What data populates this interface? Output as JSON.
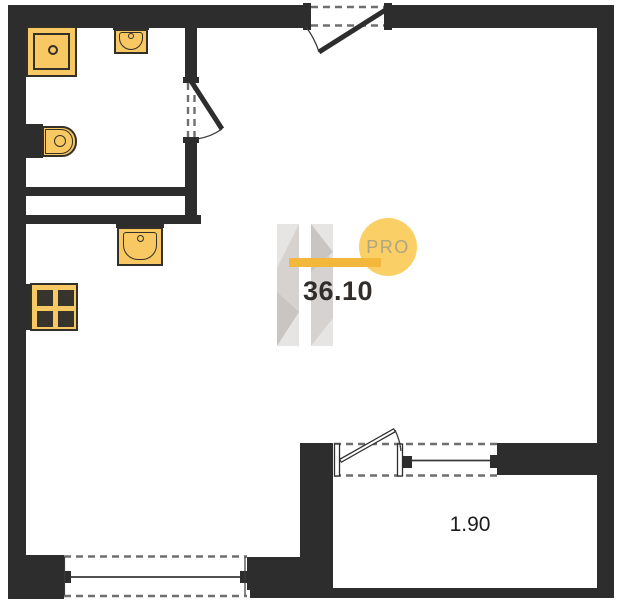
{
  "labels": {
    "area": "36.10",
    "balcony_area": "1.90",
    "logo": "PRO"
  },
  "colors": {
    "wall": "#2d2d2d",
    "line": "#2d2d2d",
    "dash": "#6f6f6f",
    "fixture-fill": "#f8c862",
    "fixture-border": "#33302a",
    "burner": "#37332d",
    "accent": "#f3b73c",
    "logo-circle": "#f9cf66",
    "logo-text": "#b0a482",
    "wm-bar": "#d5d2cf",
    "wm-light": "#e7e5e3",
    "wm-dark": "#c8c5c2",
    "area-text": "#302d2b",
    "balcony-text": "#1d1d1d"
  },
  "fixtures": [
    {
      "name": "shower"
    },
    {
      "name": "wash-basin"
    },
    {
      "name": "toilet"
    },
    {
      "name": "kitchen-sink"
    },
    {
      "name": "stove"
    }
  ]
}
